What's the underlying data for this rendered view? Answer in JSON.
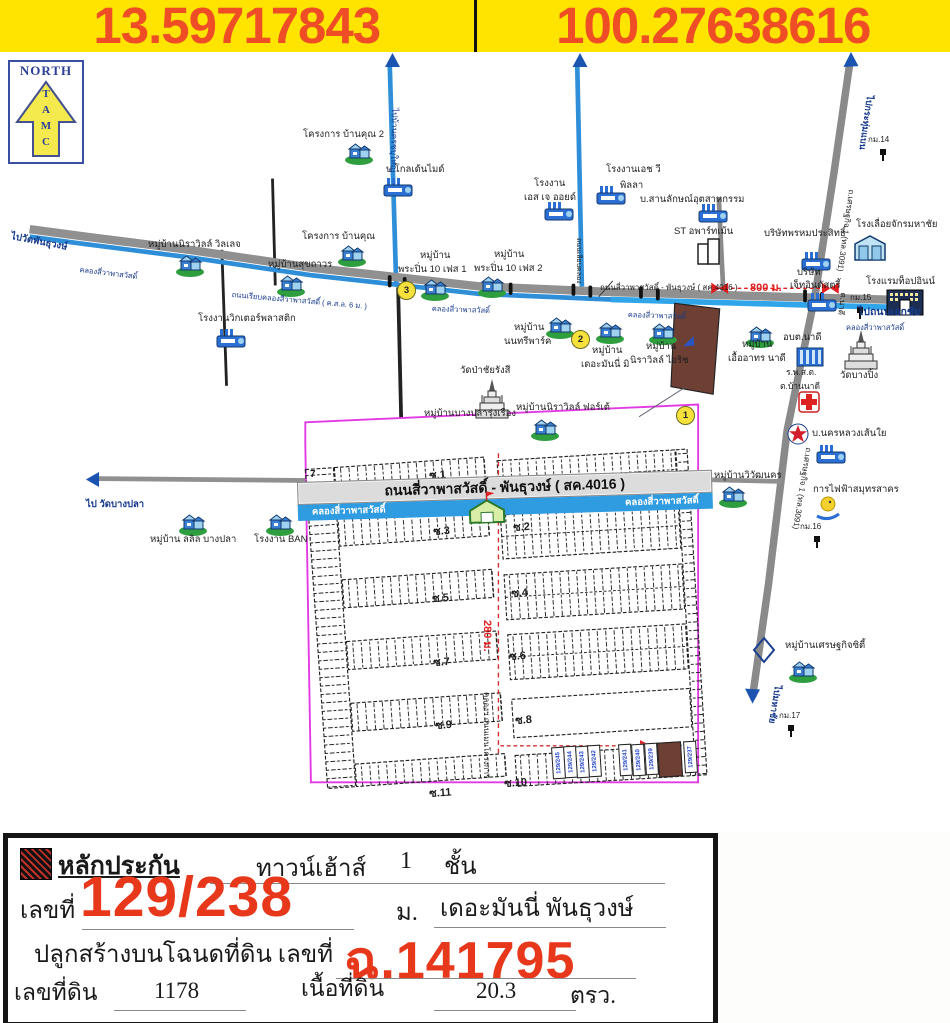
{
  "header": {
    "lat": "13.59717843",
    "lng": "100.27638616"
  },
  "compass": {
    "title": "NORTH",
    "letters": "TAMC"
  },
  "map": {
    "banner": {
      "road": "ถนนสี่วาพาสวัสดิ์ - พันธุวงษ์ ( สค.4016 )",
      "canal_left": "คลองสี่วาพาสวัสดิ์",
      "canal_right": "คลองสี่วาพาสวัสดิ์"
    },
    "labels": [
      {
        "t": "โครงการ บ้านคุณ 2",
        "x": 303,
        "y": 130
      },
      {
        "t": "บ.โกลเด้นไมด์",
        "x": 386,
        "y": 165
      },
      {
        "t": "หมู่บ้านนิราวิลล์ วิลเลจ",
        "x": 148,
        "y": 240
      },
      {
        "t": "โครงการ บ้านคุณ",
        "x": 302,
        "y": 232
      },
      {
        "t": "หมู่บ้านสุขถาวร",
        "x": 268,
        "y": 260
      },
      {
        "t": "หมู่บ้าน",
        "x": 420,
        "y": 251
      },
      {
        "t": "พระปิ่น 10 เฟส 1",
        "x": 398,
        "y": 265
      },
      {
        "t": "หมู่บ้าน",
        "x": 494,
        "y": 250
      },
      {
        "t": "พระปิ่น 10 เฟส 2",
        "x": 474,
        "y": 264
      },
      {
        "t": "โรงงานเอช วี",
        "x": 606,
        "y": 165
      },
      {
        "t": "พิลลา",
        "x": 620,
        "y": 181
      },
      {
        "t": "โรงงาน",
        "x": 534,
        "y": 179
      },
      {
        "t": "เอส เจ ออยด์",
        "x": 524,
        "y": 193
      },
      {
        "t": "บ.สานลักษณ์อุตสาหกรรม",
        "x": 640,
        "y": 195
      },
      {
        "t": "ST อพาร์ทเม้น",
        "x": 674,
        "y": 227
      },
      {
        "t": "บริษัทพรหมประสิทธิ์",
        "x": 764,
        "y": 229
      },
      {
        "t": "โรงเลื่อยจักรมหาชัย",
        "x": 856,
        "y": 220
      },
      {
        "t": "โรงแรมท็อปอินน์",
        "x": 866,
        "y": 277
      },
      {
        "t": "บริษัท",
        "x": 797,
        "y": 268
      },
      {
        "t": "เจ็ทอินดัสตรี้",
        "x": 790,
        "y": 281
      },
      {
        "t": "800 ม.",
        "x": 750,
        "y": 283,
        "c": "red b",
        "s": 11
      },
      {
        "t": "กม.14",
        "x": 868,
        "y": 136,
        "s": 8
      },
      {
        "t": "กม.15",
        "x": 850,
        "y": 294,
        "s": 8
      },
      {
        "t": "กม.16",
        "x": 800,
        "y": 523,
        "s": 8
      },
      {
        "t": "กม.17",
        "x": 779,
        "y": 712,
        "s": 8
      },
      {
        "t": "ไปกระทุ่มแบน",
        "x": 874,
        "y": 96,
        "r": 98,
        "c": "navy b",
        "s": 9
      },
      {
        "t": "ถ.เศรษฐกิจ 1 (ทล.3091)",
        "x": 855,
        "y": 190,
        "r": 98,
        "s": 8
      },
      {
        "t": "ถ.เศรษฐกิจ 1 (ทล.3091)",
        "x": 812,
        "y": 448,
        "r": 99,
        "s": 8
      },
      {
        "t": "ไปมหาชัย",
        "x": 782,
        "y": 686,
        "r": 99,
        "c": "navy b",
        "s": 9
      },
      {
        "t": "ต.นาดี",
        "x": 847,
        "y": 293,
        "r": 97,
        "s": 8
      },
      {
        "t": "ไปบ้านครชบุใหญ่",
        "x": 399,
        "y": 108,
        "r": 91,
        "c": "navy",
        "s": 8.5
      },
      {
        "t": "ถนนเลียบคลอง",
        "x": 582,
        "y": 238,
        "r": 90,
        "s": 7
      },
      {
        "t": "ไปวัดพันธุวงษ์",
        "x": 12,
        "y": 232,
        "r": 11,
        "c": "navy b",
        "s": 9.5
      },
      {
        "t": "คลองสี่วาพาสวัสดิ์",
        "x": 80,
        "y": 266,
        "r": 7,
        "c": "navy",
        "s": 7.5
      },
      {
        "t": "ถนนเรียบคลองสี่วาพาสวัสดิ์ ( ค.ส.ล. 6 ม. )",
        "x": 232,
        "y": 291,
        "r": 5,
        "c": "navy",
        "s": 7.5
      },
      {
        "t": "คลองสี่วาพาสวัสดิ์",
        "x": 432,
        "y": 305,
        "r": 2,
        "c": "navy",
        "s": 7.5
      },
      {
        "t": "คลองสี่วาพาสวัสดิ์",
        "x": 628,
        "y": 311,
        "r": 2,
        "c": "navy",
        "s": 7.5
      },
      {
        "t": "ไปถนนเอกชัย",
        "x": 858,
        "y": 307,
        "c": "navy b",
        "s": 10.5
      },
      {
        "t": "คลองสี่วาพาสวัสดิ์",
        "x": 846,
        "y": 324,
        "c": "navy",
        "s": 7.5
      },
      {
        "t": "โรงงานวิกเตอร์พลาสติก",
        "x": 198,
        "y": 314
      },
      {
        "t": "หมู่บ้าน",
        "x": 514,
        "y": 323
      },
      {
        "t": "นนทรีพาร์ค",
        "x": 504,
        "y": 337
      },
      {
        "t": "หมู่บ้าน",
        "x": 592,
        "y": 346
      },
      {
        "t": "เดอะมันนี่ มิ",
        "x": 581,
        "y": 360
      },
      {
        "t": "หมู่บ้าน",
        "x": 646,
        "y": 342
      },
      {
        "t": "นิราวิลล์ ไอริช",
        "x": 630,
        "y": 356
      },
      {
        "t": "หมู่บ้าน",
        "x": 742,
        "y": 340
      },
      {
        "t": "เอื้ออาทร นาดี",
        "x": 728,
        "y": 354
      },
      {
        "t": "อบต.นาดี",
        "x": 783,
        "y": 333
      },
      {
        "t": "ร.พ.ส.ต.",
        "x": 786,
        "y": 368,
        "s": 8.5
      },
      {
        "t": "ต.บ้านนาดี",
        "x": 780,
        "y": 382,
        "s": 8.5
      },
      {
        "t": "วัดบางปิ้ง",
        "x": 840,
        "y": 371
      },
      {
        "t": "บ.นครหลวงเส้นใย",
        "x": 812,
        "y": 429
      },
      {
        "t": "วัดป่าชัยรังสี",
        "x": 460,
        "y": 366
      },
      {
        "t": "หมู่บ้านบางปลารุ่งเรือง",
        "x": 424,
        "y": 409
      },
      {
        "t": "หมู่บ้านนิราวิลล์ ฟอร์เต้",
        "x": 516,
        "y": 403
      },
      {
        "t": "หมู่บ้านวิวัฒนคร",
        "x": 714,
        "y": 471
      },
      {
        "t": "การไฟฟ้าสมุทรสาคร",
        "x": 813,
        "y": 485
      },
      {
        "t": "หมู่บ้านเศรษฐกิจซิตี้",
        "x": 785,
        "y": 641
      },
      {
        "t": "ไป วัดบางปลา",
        "x": 86,
        "y": 500,
        "c": "navy b",
        "s": 9.5
      },
      {
        "t": "หมู่บ้าน ลลิล บางปลา",
        "x": 150,
        "y": 535
      },
      {
        "t": "โรงงาน BAN",
        "x": 254,
        "y": 535
      },
      {
        "t": "ถนนสี่วาพาสวัสดิ์ - พันธุวงษ์ ( สค.4016 )",
        "x": 600,
        "y": 284,
        "s": 8
      },
      {
        "t": "280 ม.",
        "x": 492,
        "y": 620,
        "r": 90,
        "c": "red b",
        "s": 11
      },
      {
        "t": "คลองฯ ถนนเมนโครงการ",
        "x": 490,
        "y": 692,
        "r": 90,
        "s": 8
      },
      {
        "t": "7",
        "x": 310,
        "y": 470,
        "c": "b",
        "s": 10
      },
      {
        "t": "ซ.1",
        "x": 429,
        "y": 471,
        "r": -4,
        "c": "b",
        "s": 11
      },
      {
        "t": "ซ.3",
        "x": 433,
        "y": 527,
        "r": -4,
        "c": "b",
        "s": 11
      },
      {
        "t": "ซ.2",
        "x": 513,
        "y": 523,
        "r": -4,
        "c": "b",
        "s": 11
      },
      {
        "t": "ซ.5",
        "x": 432,
        "y": 594,
        "r": -4,
        "c": "b",
        "s": 11
      },
      {
        "t": "ซ.4",
        "x": 511,
        "y": 589,
        "r": -4,
        "c": "b",
        "s": 11
      },
      {
        "t": "ซ.7",
        "x": 433,
        "y": 658,
        "r": -4,
        "c": "b",
        "s": 11
      },
      {
        "t": "ซ.6",
        "x": 509,
        "y": 652,
        "r": -4,
        "c": "b",
        "s": 11
      },
      {
        "t": "ซ.9",
        "x": 435,
        "y": 721,
        "r": -4,
        "c": "b",
        "s": 11
      },
      {
        "t": "ซ.8",
        "x": 515,
        "y": 716,
        "r": -4,
        "c": "b",
        "s": 11
      },
      {
        "t": "ซ.11",
        "x": 429,
        "y": 789,
        "r": -4,
        "c": "b",
        "s": 11
      },
      {
        "t": "ซ.10",
        "x": 504,
        "y": 779,
        "r": -4,
        "c": "b",
        "s": 11
      }
    ],
    "icons": [
      {
        "k": "house",
        "x": 175,
        "y": 253
      },
      {
        "k": "house",
        "x": 344,
        "y": 141
      },
      {
        "k": "house",
        "x": 337,
        "y": 243
      },
      {
        "k": "house",
        "x": 276,
        "y": 273
      },
      {
        "k": "house",
        "x": 420,
        "y": 277
      },
      {
        "k": "house",
        "x": 477,
        "y": 274
      },
      {
        "k": "house",
        "x": 545,
        "y": 315
      },
      {
        "k": "house",
        "x": 595,
        "y": 320
      },
      {
        "k": "house",
        "x": 648,
        "y": 321
      },
      {
        "k": "house",
        "x": 745,
        "y": 324
      },
      {
        "k": "house",
        "x": 530,
        "y": 417
      },
      {
        "k": "house",
        "x": 178,
        "y": 512
      },
      {
        "k": "house",
        "x": 265,
        "y": 512
      },
      {
        "k": "house",
        "x": 718,
        "y": 484
      },
      {
        "k": "house",
        "x": 788,
        "y": 659
      },
      {
        "k": "factory",
        "x": 382,
        "y": 176
      },
      {
        "k": "factory",
        "x": 543,
        "y": 200
      },
      {
        "k": "factory",
        "x": 595,
        "y": 184
      },
      {
        "k": "factory",
        "x": 697,
        "y": 202
      },
      {
        "k": "factory",
        "x": 800,
        "y": 250
      },
      {
        "k": "factory",
        "x": 806,
        "y": 291
      },
      {
        "k": "factory",
        "x": 815,
        "y": 443
      },
      {
        "k": "factory",
        "x": 215,
        "y": 327
      },
      {
        "k": "warehouse",
        "x": 853,
        "y": 234
      },
      {
        "k": "hotel",
        "x": 886,
        "y": 288
      },
      {
        "k": "apartment",
        "x": 696,
        "y": 236
      },
      {
        "k": "gov",
        "x": 795,
        "y": 344
      },
      {
        "k": "temple",
        "x": 474,
        "y": 379
      },
      {
        "k": "temple",
        "x": 843,
        "y": 330
      },
      {
        "k": "clinic",
        "x": 797,
        "y": 390
      },
      {
        "k": "star",
        "x": 787,
        "y": 423
      },
      {
        "k": "power",
        "x": 813,
        "y": 494
      },
      {
        "k": "drop",
        "x": 752,
        "y": 636
      },
      {
        "k": "kmpost",
        "x": 878,
        "y": 148
      },
      {
        "k": "kmpost",
        "x": 855,
        "y": 306
      },
      {
        "k": "kmpost",
        "x": 812,
        "y": 535
      },
      {
        "k": "kmpost",
        "x": 786,
        "y": 724
      }
    ],
    "badges": [
      {
        "n": "1",
        "x": 676,
        "y": 406
      },
      {
        "n": "2",
        "x": 571,
        "y": 330
      },
      {
        "n": "3",
        "x": 397,
        "y": 281
      }
    ],
    "lot_row": [
      {
        "n": "129/245",
        "x": 552,
        "y": 747
      },
      {
        "n": "129/244",
        "x": 564,
        "y": 746
      },
      {
        "n": "129/243",
        "x": 576,
        "y": 746
      },
      {
        "n": "129/242",
        "x": 588,
        "y": 745
      },
      {
        "n": "129/241",
        "x": 619,
        "y": 744
      },
      {
        "n": "129/240",
        "x": 632,
        "y": 744
      },
      {
        "n": "129/239",
        "x": 645,
        "y": 743
      },
      {
        "n": "129/238",
        "x": 658,
        "y": 742,
        "brown": true,
        "w": 22,
        "h": 33
      },
      {
        "n": "129/237",
        "x": 684,
        "y": 741
      }
    ]
  },
  "footer": {
    "collateral_label": "หลักประกัน",
    "type": "ทาวน์เฮ้าส์",
    "floors": "1",
    "floors_unit": "ชั้น",
    "no_label": "เลขที่",
    "house_no": "129/238",
    "moo_label": "ม.",
    "project": "เดอะมันนี่ พันธุวงษ์",
    "built_on_label": "ปลูกสร้างบนโฉนดที่ดิน เลขที่",
    "deed_no": "ฉ.141795",
    "land_no_label": "เลขที่ดิน",
    "land_no": "1178",
    "area_label": "เนื้อที่ดิน",
    "area": "20.3",
    "area_unit": "ตรว."
  }
}
